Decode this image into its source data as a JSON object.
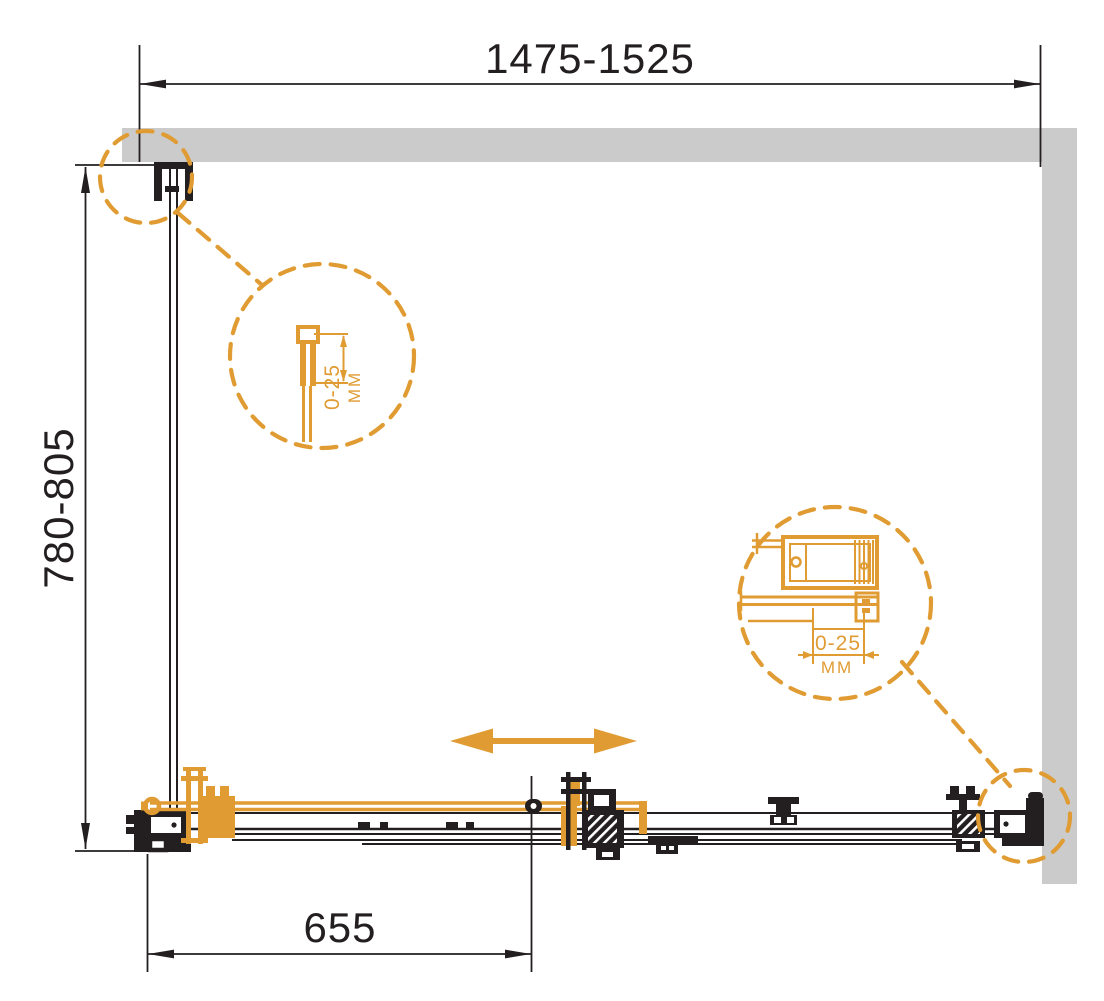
{
  "meta": {
    "title": "Shower enclosure dimensional drawing — top view"
  },
  "dimensions": {
    "top_width": "1475-1525",
    "side_depth": "780-805",
    "door_travel": "655"
  },
  "detail_left": {
    "range": "0-25",
    "unit": "MM"
  },
  "detail_right": {
    "range": "0-25",
    "unit": "MM"
  },
  "colors": {
    "accent": "#E09C33",
    "wall": "#CBCBCB",
    "line": "#231F20"
  },
  "icons": {
    "slide_direction_arrow": "double-headed horizontal arrow",
    "detail_callout": "dashed magnifier circle"
  }
}
